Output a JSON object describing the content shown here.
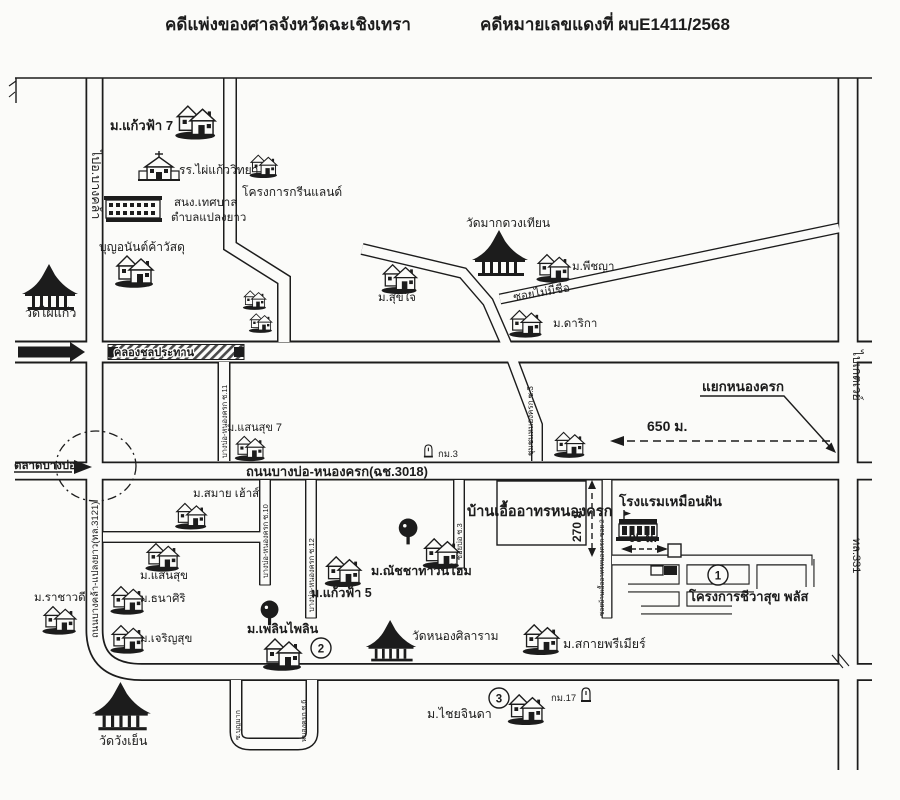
{
  "header": {
    "court_title": "คดีแพ่งของศาลจังหวัดฉะเชิงเทรา",
    "case_number": "คดีหมายเลขแดงที่ ผบE1411/2568"
  },
  "roads": {
    "to_bangkhla": "ไปอ.บางคล้า",
    "bangkhla_plaengyao": "ถนนบางคล้า-แปลงยาว(ทล.3121)",
    "canal": "คลองชลประทาน",
    "bangbo_nongkhrok": "ถนนบางบ่อ-หนองครก(ฉช.3018)",
    "to_gateway": "ไปเกตเวย์",
    "highway_331": "ทล.331",
    "soi_11": "บางบ่อ-หนองครก ซ.11",
    "soi_10": "บางบ่อ-หนองครก ซ.10",
    "soi_12": "บางบ่อ-หนองครก ซ.12",
    "soi_bo_3": "ซอยบ่อ ซ.3",
    "chumchon_soi_3": "ชุมชนหนองครก ซ.3",
    "soi_no_name": "ซอยไม่มีชื่อ",
    "soi_uea_athon_2": "ซอยบ้านเอื้ออาทรหนองครก ซอย 2",
    "soi_bunmak": "ซ.บุญมาก",
    "soi_nongkhrok_6": "หนองครก ซ.6"
  },
  "places": {
    "kaewfa7": "ม.แก้วฟ้า 7",
    "phai_kaew_school": "รร.ไผ่แก้ววิทยา",
    "greenland": "โครงการกรีนแลนด์",
    "municipal_office_1": "สนง.เทศบาล",
    "municipal_office_2": "ตำบลแปลงยาว",
    "boonanan_shop": "บุญอนันต์ค้าวัสดุ",
    "wat_phai_kaew": "วัดไผ่แก้ว",
    "wat_mak_duang_thian": "วัดมากดวงเทียน",
    "sukjai": "ม.สุขใจ",
    "phitchaya": "ม.พีชญา",
    "darika": "ม.ดาริกา",
    "sansuk7": "ม.แสนสุข 7",
    "smile_house": "ม.สมาย เฮ้าส์",
    "sansuk": "ม.แสนสุข",
    "thanasiri": "ม.ธนาศิริ",
    "charoensuk": "ม.เจริญสุข",
    "rachawadi": "ม.ราชาวดี",
    "natcha_townhome": "ม.ณัชชาทาวน์โฮม",
    "kaewfa5": "ม.แก้วฟ้า 5",
    "uea_athon": "บ้านเอื้ออาทรหนองครก",
    "muanfan_hotel": "โรงแรมเหมือนฝัน",
    "chiwasuk_plus": "โครงการชีวาสุข พลัส",
    "phloen_phailin": "ม.เพลินไพลิน",
    "wat_nong_silaram": "วัดหนองศิลาราม",
    "sky_premier": "ม.สกายพรีเมียร์",
    "chai_jinda": "ม.ไชยจินดา",
    "wat_wang_yen": "วัดวังเย็น"
  },
  "markers": {
    "junction_nongkhrok": "แยกหนองครก",
    "dist_650": "650 ม.",
    "dist_270": "270 ม.",
    "dist_95": "95 ม.",
    "km_3": "กม.3",
    "km_17": "กม.17",
    "point_1": "1",
    "point_2": "2",
    "point_3": "3",
    "market": "ตลาดบางบ่อ"
  },
  "colors": {
    "ink": "#1c1c1c",
    "paper": "#fbfbf9"
  }
}
